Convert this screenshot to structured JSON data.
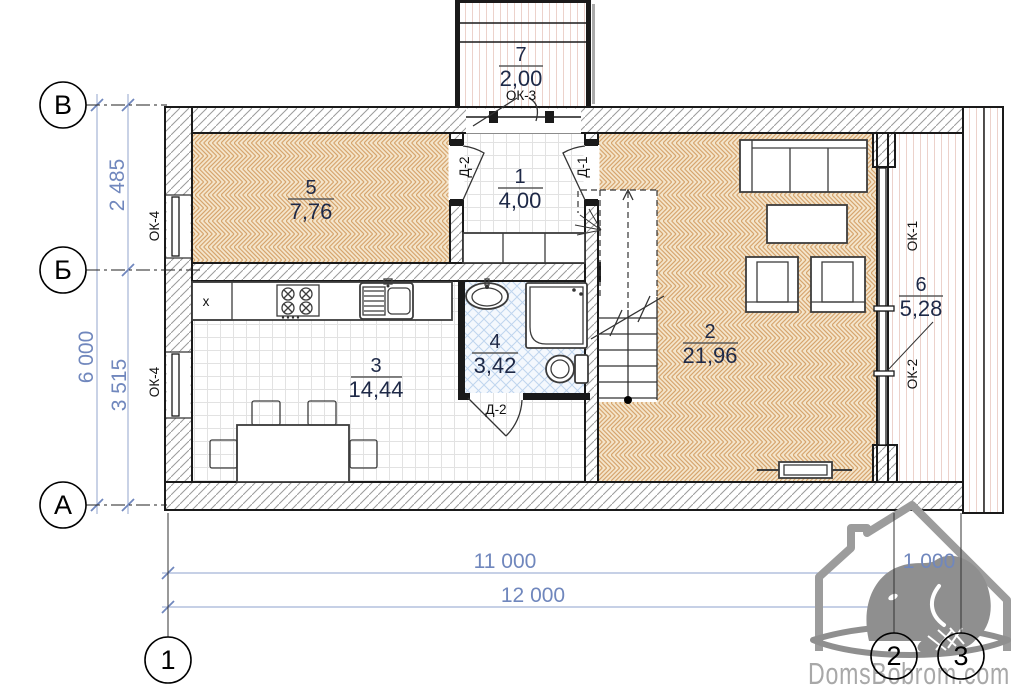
{
  "axes": {
    "rows": [
      {
        "label": "В"
      },
      {
        "label": "Б"
      },
      {
        "label": "А"
      }
    ],
    "cols": [
      {
        "label": "1"
      },
      {
        "label": "2"
      },
      {
        "label": "3"
      }
    ]
  },
  "dimensions": {
    "left": {
      "top": "2 485",
      "overall": "6 000",
      "bottom": "3 515"
    },
    "bottom": {
      "main": "11 000",
      "terrace": "1 000",
      "overall": "12 000"
    }
  },
  "rooms": {
    "r1": {
      "number": "1",
      "area": "4,00"
    },
    "r2": {
      "number": "2",
      "area": "21,96"
    },
    "r3": {
      "number": "3",
      "area": "14,44"
    },
    "r4": {
      "number": "4",
      "area": "3,42"
    },
    "r5": {
      "number": "5",
      "area": "7,76"
    },
    "r6": {
      "number": "6",
      "area": "5,28"
    },
    "r7": {
      "number": "7",
      "area": "2,00"
    }
  },
  "tags": {
    "ok1": "ОК-1",
    "ok2": "ОК-2",
    "ok3": "ОК-3",
    "ok4_upper": "ОК-4",
    "ok4_lower": "ОК-4",
    "d1": "Д-1",
    "d2_hall": "Д-2",
    "d2_bath": "Д-2",
    "appliance_mark": "х"
  },
  "watermark": {
    "text": "DomsBobrom.com"
  },
  "colors": {
    "dimension_text": "#7087bd",
    "parquet": "#d6a46d",
    "bath_tile": "#bfd5ee",
    "wall_hatch": "#9b9b9b",
    "deck": "#ecd2cb",
    "watermark_gray": "#a8a8a8"
  }
}
